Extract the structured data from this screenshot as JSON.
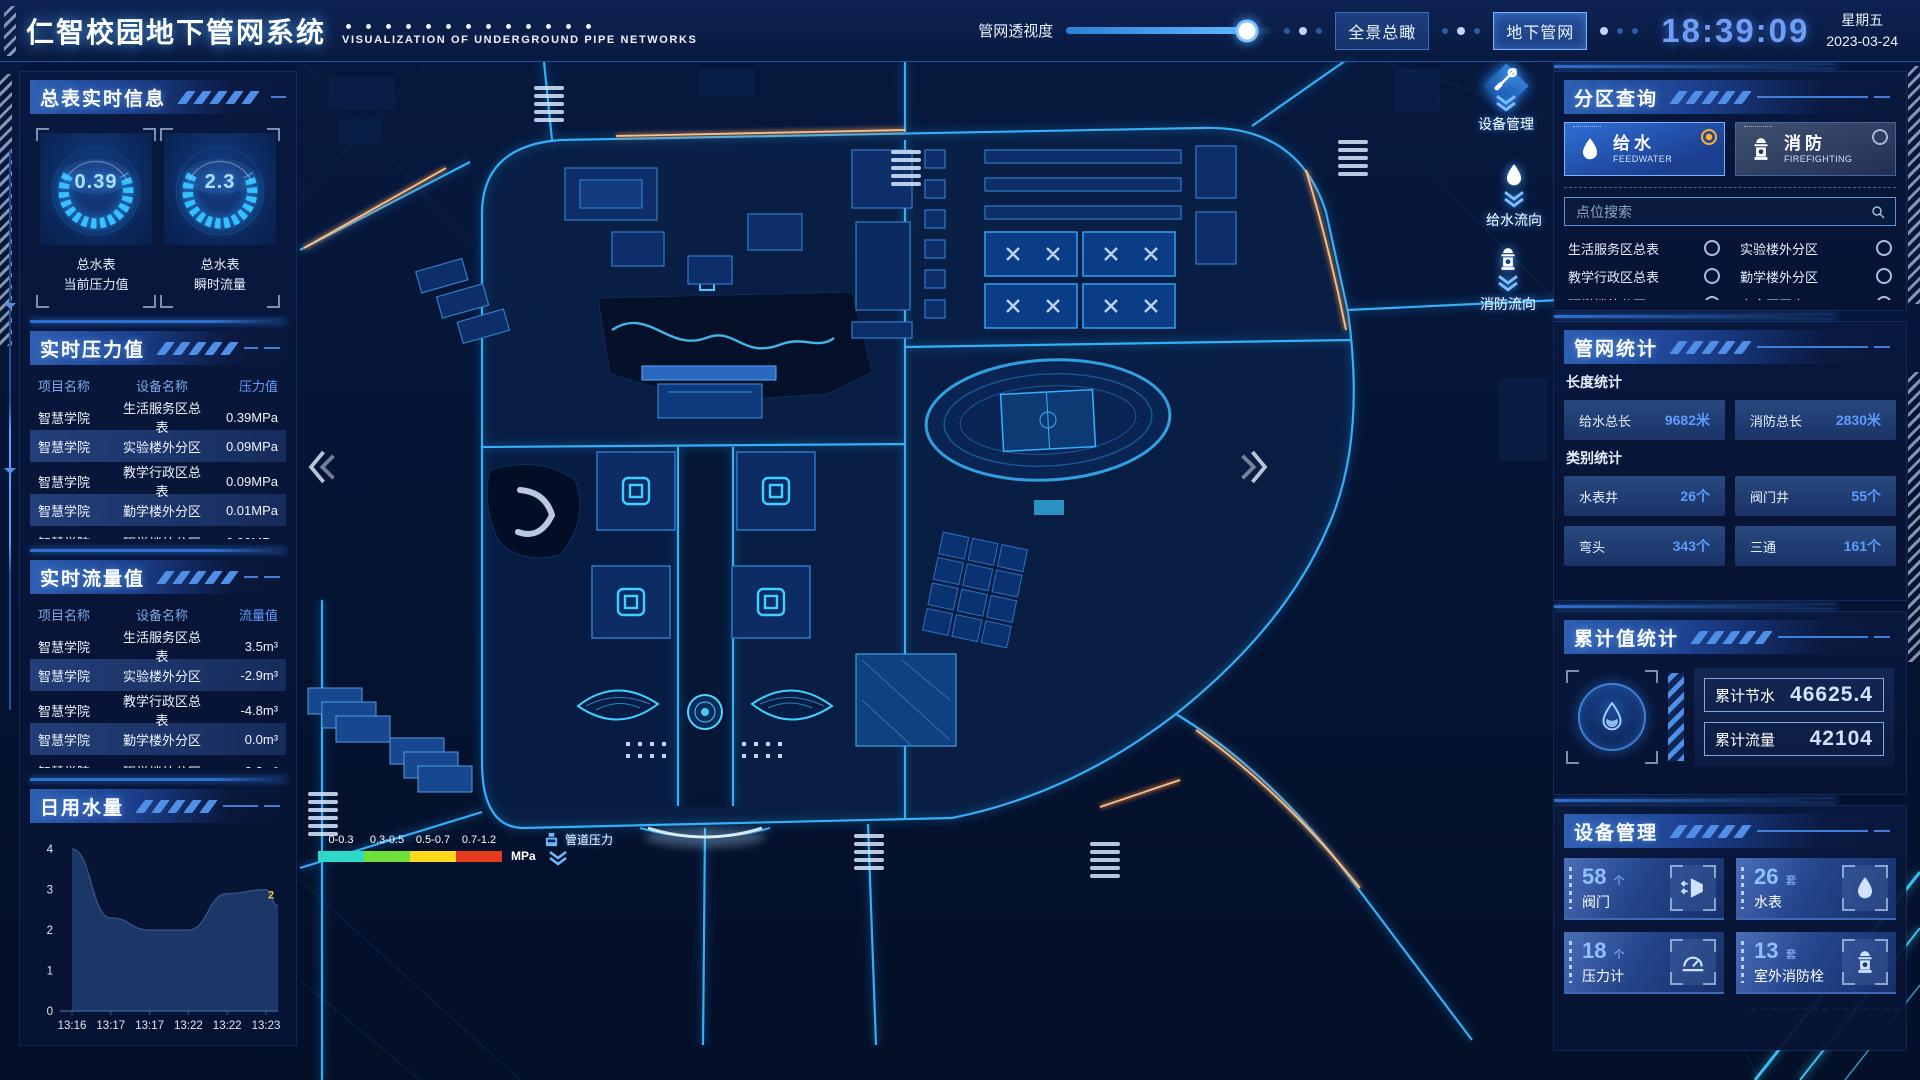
{
  "header": {
    "title": "仁智校园地下管网系统",
    "subtitle": "VISUALIZATION OF UNDERGROUND PIPE NETWORKS",
    "transparency_label": "管网透视度",
    "transparency_percent": 88,
    "buttons": [
      {
        "label": "全景总瞰"
      },
      {
        "label": "地下管网"
      }
    ],
    "time": "18:39:09",
    "weekday": "星期五",
    "date": "2023-03-24"
  },
  "left_panel": {
    "meter_info": {
      "title": "总表实时信息",
      "gauges": [
        {
          "value": "0.39",
          "label_lines": [
            "总水表",
            "当前压力值"
          ]
        },
        {
          "value": "2.3",
          "label_lines": [
            "总水表",
            "瞬时流量"
          ]
        }
      ]
    },
    "pressure": {
      "title": "实时压力值",
      "headers": [
        "项目名称",
        "设备名称",
        "压力值"
      ],
      "rows": [
        [
          "智慧学院",
          "生活服务区总表",
          "0.39MPa"
        ],
        [
          "智慧学院",
          "实验楼外分区",
          "0.09MPa"
        ],
        [
          "智慧学院",
          "教学行政区总表",
          "0.09MPa"
        ],
        [
          "智慧学院",
          "勤学楼外分区",
          "0.01MPa"
        ],
        [
          "智慧学院",
          "砺学楼外分区",
          "0.00MPa"
        ]
      ]
    },
    "flow": {
      "title": "实时流量值",
      "headers": [
        "项目名称",
        "设备名称",
        "流量值"
      ],
      "rows": [
        [
          "智慧学院",
          "生活服务区总表",
          "3.5m³"
        ],
        [
          "智慧学院",
          "实验楼外分区",
          "-2.9m³"
        ],
        [
          "智慧学院",
          "教学行政区总表",
          "-4.8m³"
        ],
        [
          "智慧学院",
          "勤学楼外分区",
          "0.0m³"
        ],
        [
          "智慧学院",
          "砺学楼外分区",
          "2.3m³"
        ]
      ]
    },
    "daily_water_title": "日用水量"
  },
  "chart_data": {
    "type": "area",
    "title": "日用水量",
    "x": [
      "13:16",
      "13:17",
      "13:17",
      "13:22",
      "13:22",
      "13:23"
    ],
    "values": [
      4,
      2.3,
      2,
      2,
      2.9,
      3
    ],
    "right_edge_value": 2.6,
    "end_label": "2",
    "yticks": [
      0,
      1,
      2,
      3,
      4
    ],
    "ylim": [
      0,
      4
    ],
    "area_color": "#1e3c70"
  },
  "map": {
    "legend": {
      "labels": [
        "0-0.3",
        "0.3-0.5",
        "0.5-0.7",
        "0.7-1.2"
      ],
      "colors": [
        "#2ed9c8",
        "#6ee03a",
        "#ffd81e",
        "#e63a1e"
      ],
      "unit": "MPa",
      "marker_label": "管道压力"
    },
    "markers": [
      {
        "label": "设备管理",
        "icon": "wrench-icon"
      },
      {
        "label": "给水流向",
        "icon": "water-drop-icon"
      },
      {
        "label": "消防流向",
        "icon": "hydrant-icon"
      }
    ]
  },
  "right_panel": {
    "zone_query": {
      "title": "分区查询",
      "tabs": [
        {
          "label": "给水",
          "sub": "FEEDWATER",
          "active": true
        },
        {
          "label": "消防",
          "sub": "FIREFIGHTING",
          "active": false
        }
      ],
      "search_placeholder": "点位搜索",
      "points": [
        "生活服务区总表",
        "实验楼外分区",
        "教学行政区总表",
        "勤学楼外分区",
        "砺学楼外分区",
        "宿舍区泵房"
      ]
    },
    "pipe_stats": {
      "title": "管网统计",
      "length_label": "长度统计",
      "length_stats": [
        {
          "label": "给水总长",
          "value": "9682米"
        },
        {
          "label": "消防总长",
          "value": "2830米"
        }
      ],
      "category_label": "类别统计",
      "category_stats": [
        {
          "label": "水表井",
          "value": "26个"
        },
        {
          "label": "阀门井",
          "value": "55个"
        },
        {
          "label": "弯头",
          "value": "343个"
        },
        {
          "label": "三通",
          "value": "161个"
        }
      ]
    },
    "cumulative": {
      "title": "累计值统计",
      "items": [
        {
          "label": "累计节水",
          "value": "46625.4"
        },
        {
          "label": "累计流量",
          "value": "42104"
        }
      ]
    },
    "devices": {
      "title": "设备管理",
      "cards": [
        {
          "count": "58",
          "unit": "个",
          "name": "阀门",
          "icon": "valve-icon"
        },
        {
          "count": "26",
          "unit": "套",
          "name": "水表",
          "icon": "water-meter-icon"
        },
        {
          "count": "18",
          "unit": "个",
          "name": "压力计",
          "icon": "pressure-gauge-icon"
        },
        {
          "count": "13",
          "unit": "套",
          "name": "室外消防栓",
          "icon": "hydrant-icon"
        }
      ]
    }
  }
}
